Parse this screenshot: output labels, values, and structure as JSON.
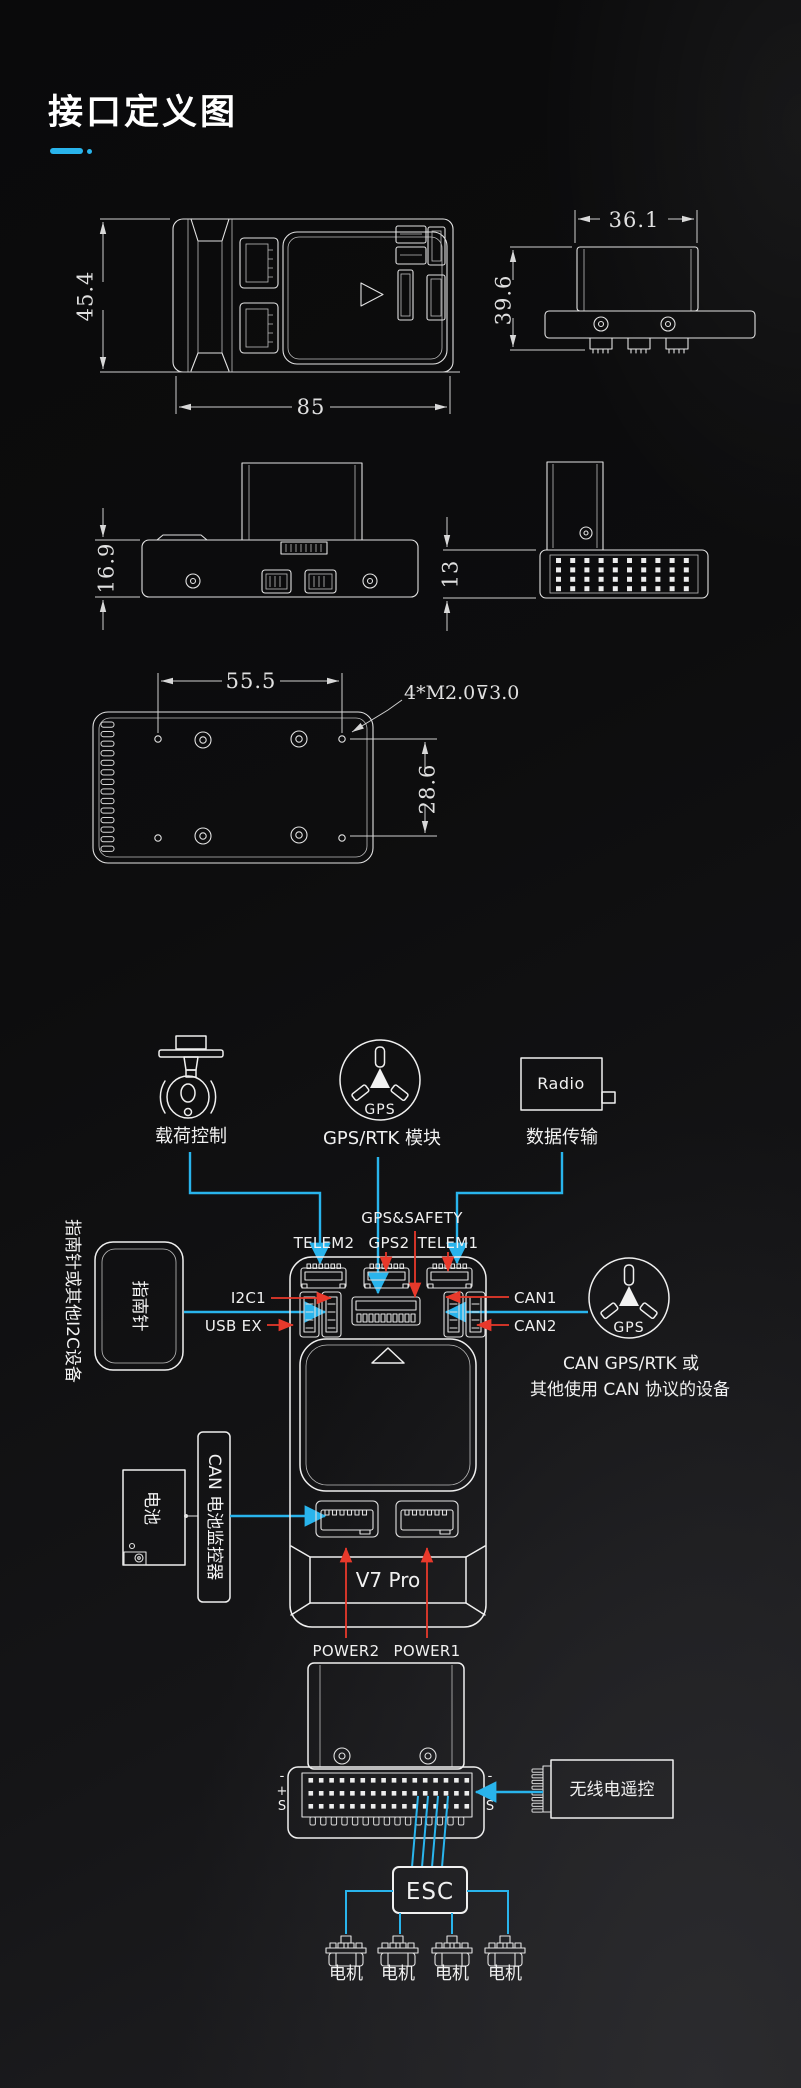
{
  "page": {
    "title": "接口定义图",
    "colors": {
      "accent": "#29b4ec",
      "red": "#e8392b",
      "line": "#e2e2e2",
      "background_dark": "#0a0a0b",
      "background_light": "#202023"
    }
  },
  "dimensions": {
    "top_view": {
      "height": "45.4",
      "width": "85"
    },
    "side_view": {
      "width": "36.1",
      "height": "39.6"
    },
    "front_view": {
      "base_height": "16.9"
    },
    "rear_view": {
      "height": "13"
    },
    "bottom_view": {
      "hole_spacing_x": "55.5",
      "hole_spacing_y": "28.6",
      "thread_note": "4*M2.0⊽3.0"
    }
  },
  "peripherals": {
    "payload": {
      "label": "载荷控制"
    },
    "gps_rtk": {
      "label": "GPS/RTK 模块",
      "icon_text": "GPS"
    },
    "radio": {
      "label": "数据传输",
      "box_text": "Radio"
    },
    "compass": {
      "box_text": "指南针",
      "side_label": "指南针或其他I2C设备"
    },
    "can_gps": {
      "label_line1": "CAN GPS/RTK 或",
      "label_line2": "其他使用 CAN 协议的设备"
    },
    "battery": {
      "box_text": "电池"
    },
    "battery_monitor": {
      "box_text": "CAN 电池监控器"
    },
    "radio_control": {
      "box_text": "无线电遥控"
    },
    "esc": {
      "box_text": "ESC"
    },
    "motors": [
      "电机",
      "电机",
      "电机",
      "电机"
    ]
  },
  "controller": {
    "model": "V7 Pro",
    "ports": {
      "gps_safety": "GPS&SAFETY",
      "telem2": "TELEM2",
      "gps2": "GPS2",
      "telem1": "TELEM1",
      "i2c1": "I2C1",
      "usb_ex": "USB EX",
      "can1": "CAN1",
      "can2": "CAN2",
      "power2": "POWER2",
      "power1": "POWER1"
    },
    "pin_row_labels": {
      "minus": "-",
      "plus": "+",
      "signal": "S"
    }
  }
}
